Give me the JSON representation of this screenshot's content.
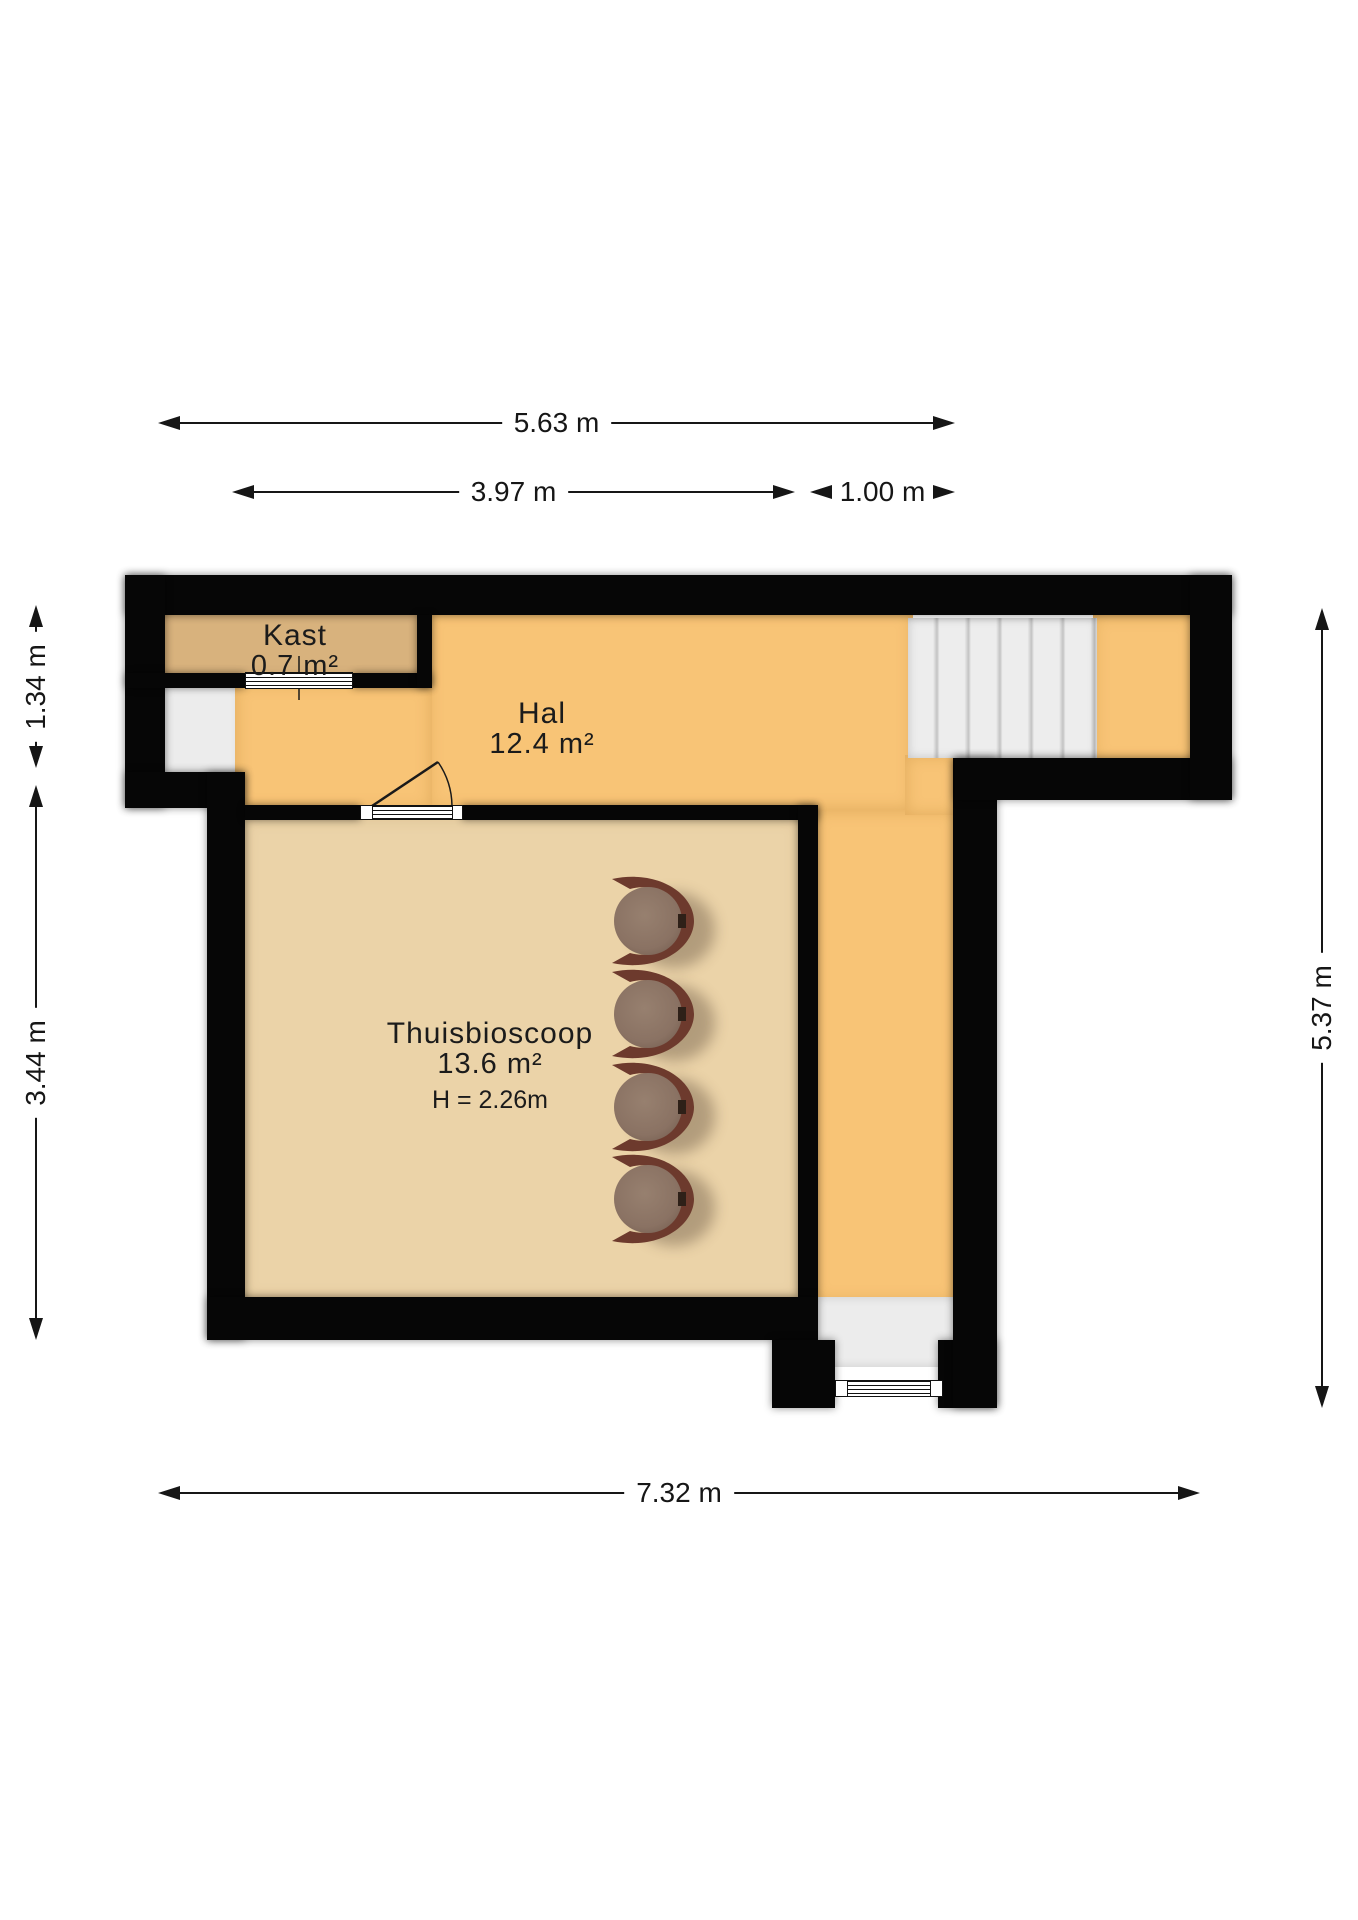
{
  "plan": {
    "type": "floorplan",
    "rooms": {
      "kast": {
        "name": "Kast",
        "area": "0.7 m²"
      },
      "hal": {
        "name": "Hal",
        "area": "12.4 m²"
      },
      "thuisbioscoop": {
        "name": "Thuisbioscoop",
        "area": "13.6 m²",
        "ceiling_height": "H = 2.26m"
      }
    },
    "dimensions": {
      "top_total": "5.63 m",
      "top_hal": "3.97 m",
      "top_right": "1.00 m",
      "left_upper": "1.34 m",
      "left_lower": "3.44 m",
      "right_side": "5.37 m",
      "bottom_total": "7.32 m"
    },
    "furniture": {
      "cinema_seats": 4
    },
    "colors": {
      "wall": "#060606",
      "hal_floor": "#F8C476",
      "kast_floor": "#D8B27D",
      "thuisbioscoop_floor": "#EBD3A8",
      "stairs": "#ECECEC",
      "chair_seat": "#8D7565",
      "chair_frame": "#6D3A2D",
      "background": "#FFFFFF"
    }
  }
}
